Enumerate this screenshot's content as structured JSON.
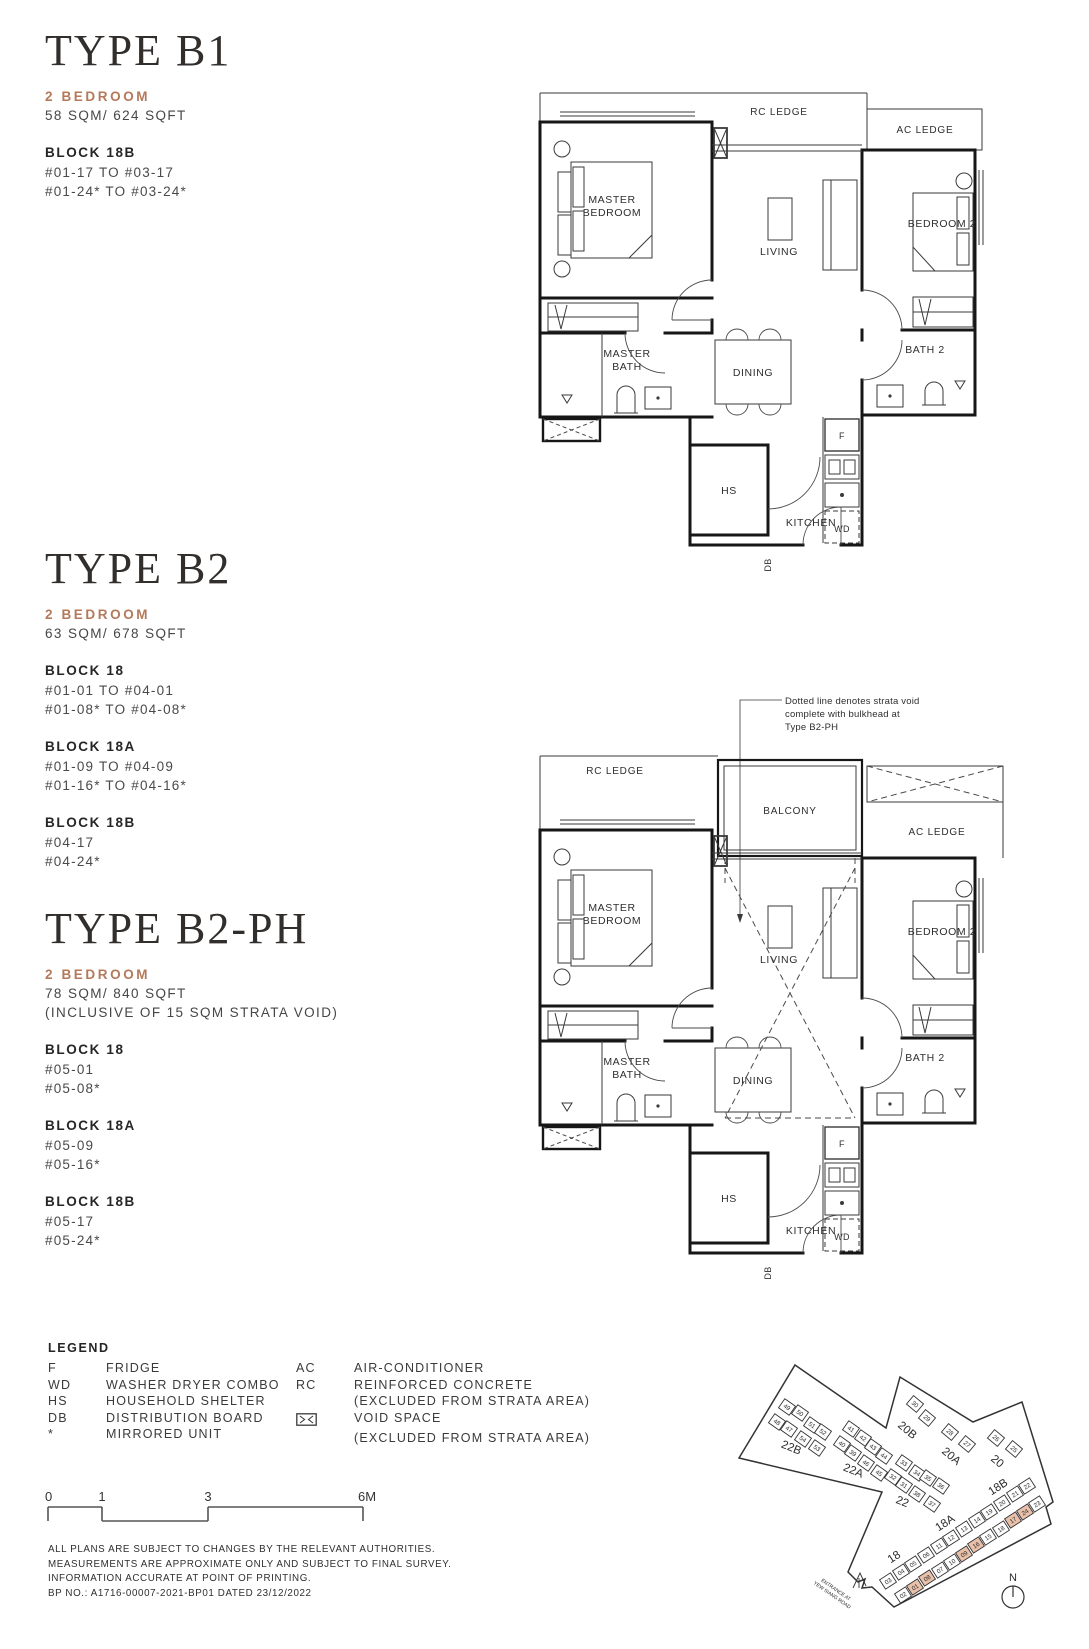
{
  "plan_labels": {
    "rc_ledge": "RC LEDGE",
    "ac_ledge": "AC LEDGE",
    "master": "MASTER",
    "bedroom": "BEDROOM",
    "bath": "BATH",
    "living": "LIVING",
    "bedroom_2": "BEDROOM 2",
    "dining": "DINING",
    "bath_2": "BATH 2",
    "hs": "HS",
    "kitchen": "KITCHEN",
    "fridge": "F",
    "wd": "WD",
    "db": "DB",
    "balcony": "BALCONY"
  },
  "types": {
    "b1": {
      "title": "TYPE B1",
      "bedroom": "2 BEDROOM",
      "area": "58 SQM/ 624 SQFT",
      "blocks": [
        {
          "name": "BLOCK 18B",
          "lines": [
            "#01-17 TO #03-17",
            "#01-24* TO #03-24*"
          ]
        }
      ]
    },
    "b2": {
      "title": "TYPE B2",
      "bedroom": "2 BEDROOM",
      "area": "63 SQM/ 678 SQFT",
      "blocks": [
        {
          "name": "BLOCK 18",
          "lines": [
            "#01-01 TO #04-01",
            "#01-08* TO #04-08*"
          ]
        },
        {
          "name": "BLOCK 18A",
          "lines": [
            "#01-09 TO #04-09",
            "#01-16* TO #04-16*"
          ]
        },
        {
          "name": "BLOCK 18B",
          "lines": [
            "#04-17",
            "#04-24*"
          ]
        }
      ]
    },
    "b2ph": {
      "title": "TYPE B2-PH",
      "bedroom": "2 BEDROOM",
      "area": "78 SQM/ 840 SQFT",
      "area_note": "(INCLUSIVE OF 15 SQM STRATA VOID)",
      "blocks": [
        {
          "name": "BLOCK 18",
          "lines": [
            "#05-01",
            "#05-08*"
          ]
        },
        {
          "name": "BLOCK 18A",
          "lines": [
            "#05-09",
            "#05-16*"
          ]
        },
        {
          "name": "BLOCK 18B",
          "lines": [
            "#05-17",
            "#05-24*"
          ]
        }
      ]
    }
  },
  "annotation": {
    "lines": [
      "Dotted line denotes strata void",
      "complete with bulkhead at",
      "Type B2-PH"
    ]
  },
  "legend": {
    "heading": "LEGEND",
    "left": [
      {
        "abbr": "F",
        "desc": "FRIDGE"
      },
      {
        "abbr": "WD",
        "desc": "WASHER DRYER COMBO"
      },
      {
        "abbr": "HS",
        "desc": "HOUSEHOLD SHELTER"
      },
      {
        "abbr": "DB",
        "desc": "DISTRIBUTION BOARD"
      },
      {
        "abbr": "*",
        "desc": "MIRRORED UNIT"
      }
    ],
    "right": [
      {
        "abbr": "AC",
        "desc": "AIR-CONDITIONER"
      },
      {
        "abbr": "RC",
        "desc": "REINFORCED CONCRETE"
      },
      {
        "abbr": "",
        "desc": "(EXCLUDED FROM STRATA AREA)"
      },
      {
        "abbr": "",
        "desc": "VOID SPACE"
      },
      {
        "abbr": "",
        "desc": "(EXCLUDED FROM STRATA AREA)"
      }
    ]
  },
  "scale": {
    "ticks": [
      "0",
      "1",
      "3",
      "6M"
    ]
  },
  "disclaimer": [
    "ALL PLANS ARE SUBJECT TO CHANGES BY THE RELEVANT AUTHORITIES.",
    "MEASUREMENTS ARE APPROXIMATE ONLY AND SUBJECT TO FINAL SURVEY.",
    "INFORMATION ACCURATE AT POINT OF PRINTING.",
    "BP NO.: A1716-00007-2021-BP01 DATED 23/12/2022"
  ],
  "site_map": {
    "highlight_color": "#e9c0a9",
    "north_label": "N",
    "boundary": [
      [
        95,
        15
      ],
      [
        186,
        78
      ],
      [
        200,
        27
      ],
      [
        273,
        72
      ],
      [
        322,
        52
      ],
      [
        353,
        152
      ],
      [
        346,
        157
      ],
      [
        351,
        174
      ],
      [
        194,
        257
      ],
      [
        172,
        237
      ],
      [
        162,
        238
      ],
      [
        165,
        229
      ],
      [
        158,
        232
      ],
      [
        148,
        222
      ],
      [
        182,
        142
      ],
      [
        39,
        108
      ]
    ],
    "entrance": {
      "lines": [
        "ENTRANCE AT",
        "YEW SIANG ROAD"
      ],
      "x": 135,
      "y": 241,
      "rot": 35
    },
    "block_labels": [
      {
        "text": "22B",
        "x": 90,
        "y": 101,
        "rot": 22
      },
      {
        "text": "22A",
        "x": 152,
        "y": 124,
        "rot": 22
      },
      {
        "text": "22",
        "x": 201,
        "y": 155,
        "rot": 22
      },
      {
        "text": "20B",
        "x": 205,
        "y": 83,
        "rot": 40
      },
      {
        "text": "20A",
        "x": 249,
        "y": 109,
        "rot": 40
      },
      {
        "text": "20",
        "x": 295,
        "y": 114,
        "rot": 40
      },
      {
        "text": "18",
        "x": 196,
        "y": 210,
        "rot": -33
      },
      {
        "text": "18A",
        "x": 247,
        "y": 176,
        "rot": -33
      },
      {
        "text": "18B",
        "x": 300,
        "y": 140,
        "rot": -33
      }
    ],
    "units": [
      {
        "n": "02",
        "x": 203,
        "y": 245,
        "r": -33
      },
      {
        "n": "01",
        "x": 215,
        "y": 237,
        "r": -33,
        "h": 1
      },
      {
        "n": "08",
        "x": 227,
        "y": 228,
        "r": -33,
        "h": 1
      },
      {
        "n": "07",
        "x": 240,
        "y": 220,
        "r": -33
      },
      {
        "n": "10",
        "x": 252,
        "y": 212,
        "r": -33
      },
      {
        "n": "09",
        "x": 264,
        "y": 204,
        "r": -33,
        "h": 1
      },
      {
        "n": "16",
        "x": 276,
        "y": 195,
        "r": -33,
        "h": 1
      },
      {
        "n": "15",
        "x": 288,
        "y": 187,
        "r": -33
      },
      {
        "n": "18",
        "x": 301,
        "y": 179,
        "r": -33
      },
      {
        "n": "17",
        "x": 313,
        "y": 170,
        "r": -33,
        "h": 1
      },
      {
        "n": "24",
        "x": 325,
        "y": 162,
        "r": -33,
        "h": 1
      },
      {
        "n": "23",
        "x": 337,
        "y": 154,
        "r": -33
      },
      {
        "n": "03",
        "x": 188,
        "y": 231,
        "r": -33
      },
      {
        "n": "04",
        "x": 201,
        "y": 222,
        "r": -33
      },
      {
        "n": "05",
        "x": 213,
        "y": 214,
        "r": -33
      },
      {
        "n": "06",
        "x": 226,
        "y": 205,
        "r": -33
      },
      {
        "n": "11",
        "x": 239,
        "y": 196,
        "r": -33
      },
      {
        "n": "12",
        "x": 251,
        "y": 188,
        "r": -33
      },
      {
        "n": "13",
        "x": 264,
        "y": 179,
        "r": -33
      },
      {
        "n": "14",
        "x": 277,
        "y": 170,
        "r": -33
      },
      {
        "n": "19",
        "x": 289,
        "y": 162,
        "r": -33
      },
      {
        "n": "20",
        "x": 302,
        "y": 153,
        "r": -33
      },
      {
        "n": "21",
        "x": 315,
        "y": 144,
        "r": -33
      },
      {
        "n": "22",
        "x": 327,
        "y": 136,
        "r": -33
      },
      {
        "n": "30",
        "x": 215,
        "y": 54,
        "r": 40
      },
      {
        "n": "29",
        "x": 227,
        "y": 68,
        "r": 40
      },
      {
        "n": "28",
        "x": 250,
        "y": 82,
        "r": 40
      },
      {
        "n": "27",
        "x": 267,
        "y": 94,
        "r": 40
      },
      {
        "n": "26",
        "x": 296,
        "y": 88,
        "r": 40
      },
      {
        "n": "25",
        "x": 314,
        "y": 99,
        "r": 40
      },
      {
        "n": "49",
        "x": 87,
        "y": 57,
        "r": 35
      },
      {
        "n": "50",
        "x": 100,
        "y": 63,
        "r": 35
      },
      {
        "n": "51",
        "x": 112,
        "y": 75,
        "r": 35
      },
      {
        "n": "52",
        "x": 123,
        "y": 82,
        "r": 35
      },
      {
        "n": "48",
        "x": 77,
        "y": 72,
        "r": 35
      },
      {
        "n": "47",
        "x": 89,
        "y": 79,
        "r": 35
      },
      {
        "n": "54",
        "x": 103,
        "y": 89,
        "r": 35
      },
      {
        "n": "53",
        "x": 117,
        "y": 98,
        "r": 35
      },
      {
        "n": "41",
        "x": 151,
        "y": 79,
        "r": 35
      },
      {
        "n": "42",
        "x": 163,
        "y": 88,
        "r": 35
      },
      {
        "n": "43",
        "x": 173,
        "y": 97,
        "r": 35
      },
      {
        "n": "44",
        "x": 184,
        "y": 106,
        "r": 35
      },
      {
        "n": "40",
        "x": 142,
        "y": 94,
        "r": 35
      },
      {
        "n": "39",
        "x": 153,
        "y": 103,
        "r": 35
      },
      {
        "n": "46",
        "x": 166,
        "y": 113,
        "r": 35
      },
      {
        "n": "45",
        "x": 179,
        "y": 123,
        "r": 35
      },
      {
        "n": "33",
        "x": 204,
        "y": 113,
        "r": 35
      },
      {
        "n": "34",
        "x": 217,
        "y": 123,
        "r": 35
      },
      {
        "n": "35",
        "x": 228,
        "y": 128,
        "r": 35
      },
      {
        "n": "36",
        "x": 241,
        "y": 136,
        "r": 35
      },
      {
        "n": "32",
        "x": 193,
        "y": 127,
        "r": 35
      },
      {
        "n": "31",
        "x": 204,
        "y": 135,
        "r": 35
      },
      {
        "n": "38",
        "x": 217,
        "y": 144,
        "r": 35
      },
      {
        "n": "37",
        "x": 232,
        "y": 154,
        "r": 35
      }
    ]
  }
}
